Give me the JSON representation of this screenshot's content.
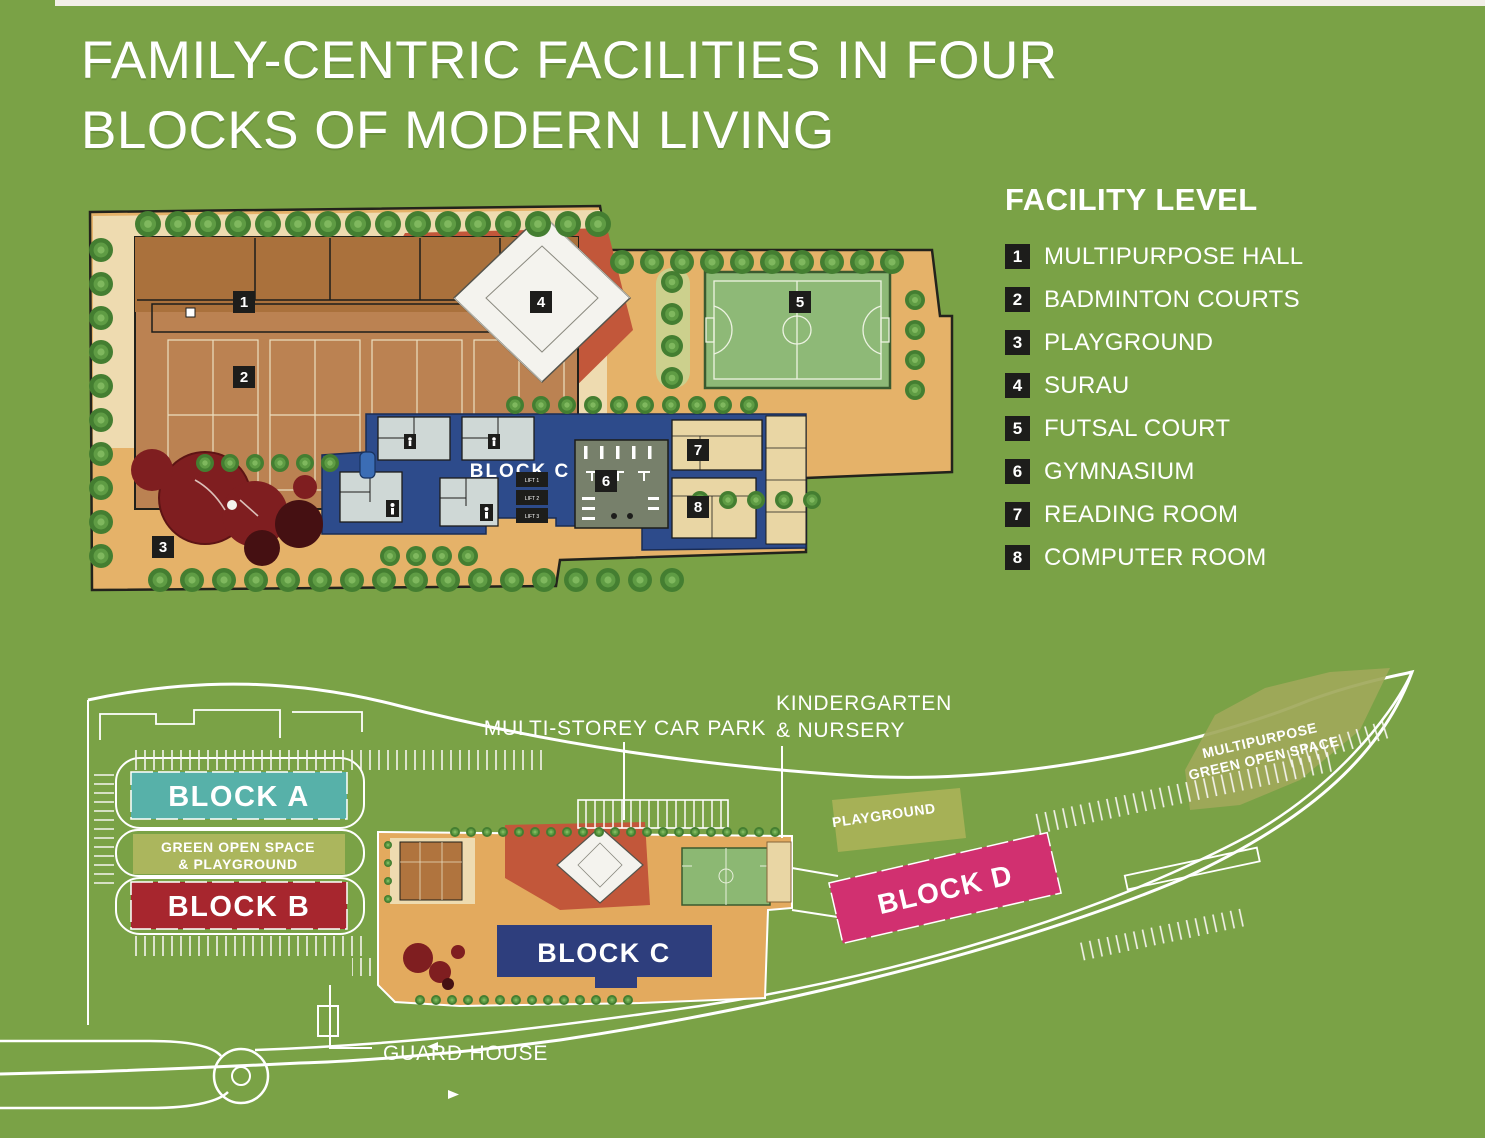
{
  "page": {
    "background": "#7aa246",
    "top_strip_color": "#f2efe7"
  },
  "title": {
    "line1": "FAMILY-CENTRIC FACILITIES IN FOUR",
    "line2": "BLOCKS OF MODERN LIVING"
  },
  "legend": {
    "title": "FACILITY LEVEL",
    "items": [
      {
        "num": "1",
        "label": "MULTIPURPOSE HALL"
      },
      {
        "num": "2",
        "label": "BADMINTON COURTS"
      },
      {
        "num": "3",
        "label": "PLAYGROUND"
      },
      {
        "num": "4",
        "label": "SURAU"
      },
      {
        "num": "5",
        "label": "FUTSAL COURT"
      },
      {
        "num": "6",
        "label": "GYMNASIUM"
      },
      {
        "num": "7",
        "label": "READING ROOM"
      },
      {
        "num": "8",
        "label": "COMPUTER ROOM"
      }
    ]
  },
  "facility_plan": {
    "block_label": "BLOCK C",
    "deck_color": "#2d4b8b",
    "futsal_color": "#8eb977",
    "terracotta_color": "#c2573a",
    "lift_labels": [
      "LIFT 1",
      "LIFT 2",
      "LIFT 3"
    ]
  },
  "site_plan": {
    "blocks": [
      {
        "label": "BLOCK A",
        "color": "#57b1a9"
      },
      {
        "label": "BLOCK B",
        "color": "#a7262e"
      },
      {
        "label": "BLOCK C",
        "color": "#2e3e7d"
      },
      {
        "label": "BLOCK D",
        "color": "#d13070"
      }
    ],
    "green_open_space_line1": "GREEN OPEN SPACE",
    "green_open_space_line2": "& PLAYGROUND",
    "car_park_label": "MULTI-STOREY CAR PARK",
    "kindergarten_line1": "KINDERGARTEN",
    "kindergarten_line2": "& NURSERY",
    "playground_label": "PLAYGROUND",
    "multipurpose_green_line1": "MULTIPURPOSE",
    "multipurpose_green_line2": "GREEN OPEN SPACE",
    "guard_house_label": "GUARD HOUSE"
  }
}
